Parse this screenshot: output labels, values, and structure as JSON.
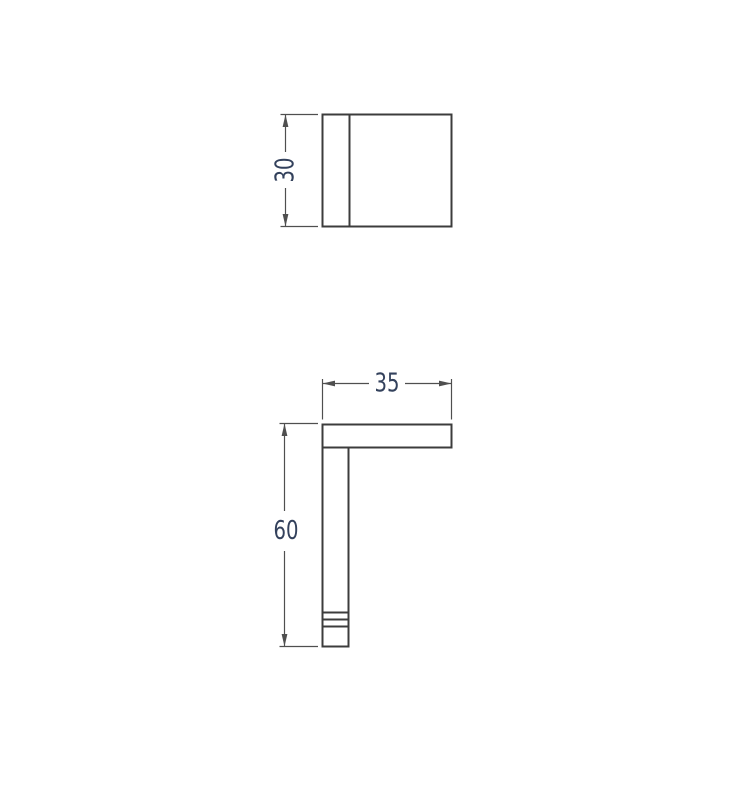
{
  "drawing": {
    "background_color": "#ffffff",
    "part_outline_color": "#3c3c3c",
    "dimension_line_color": "#4f4f4f",
    "dimension_text_color": "#33415c",
    "dimensions": {
      "top_view_height": {
        "label": "30",
        "value": 30,
        "orientation": "vertical"
      },
      "front_view_width": {
        "label": "35",
        "value": 35,
        "orientation": "horizontal"
      },
      "front_view_height": {
        "label": "60",
        "value": 60,
        "orientation": "vertical"
      }
    }
  }
}
